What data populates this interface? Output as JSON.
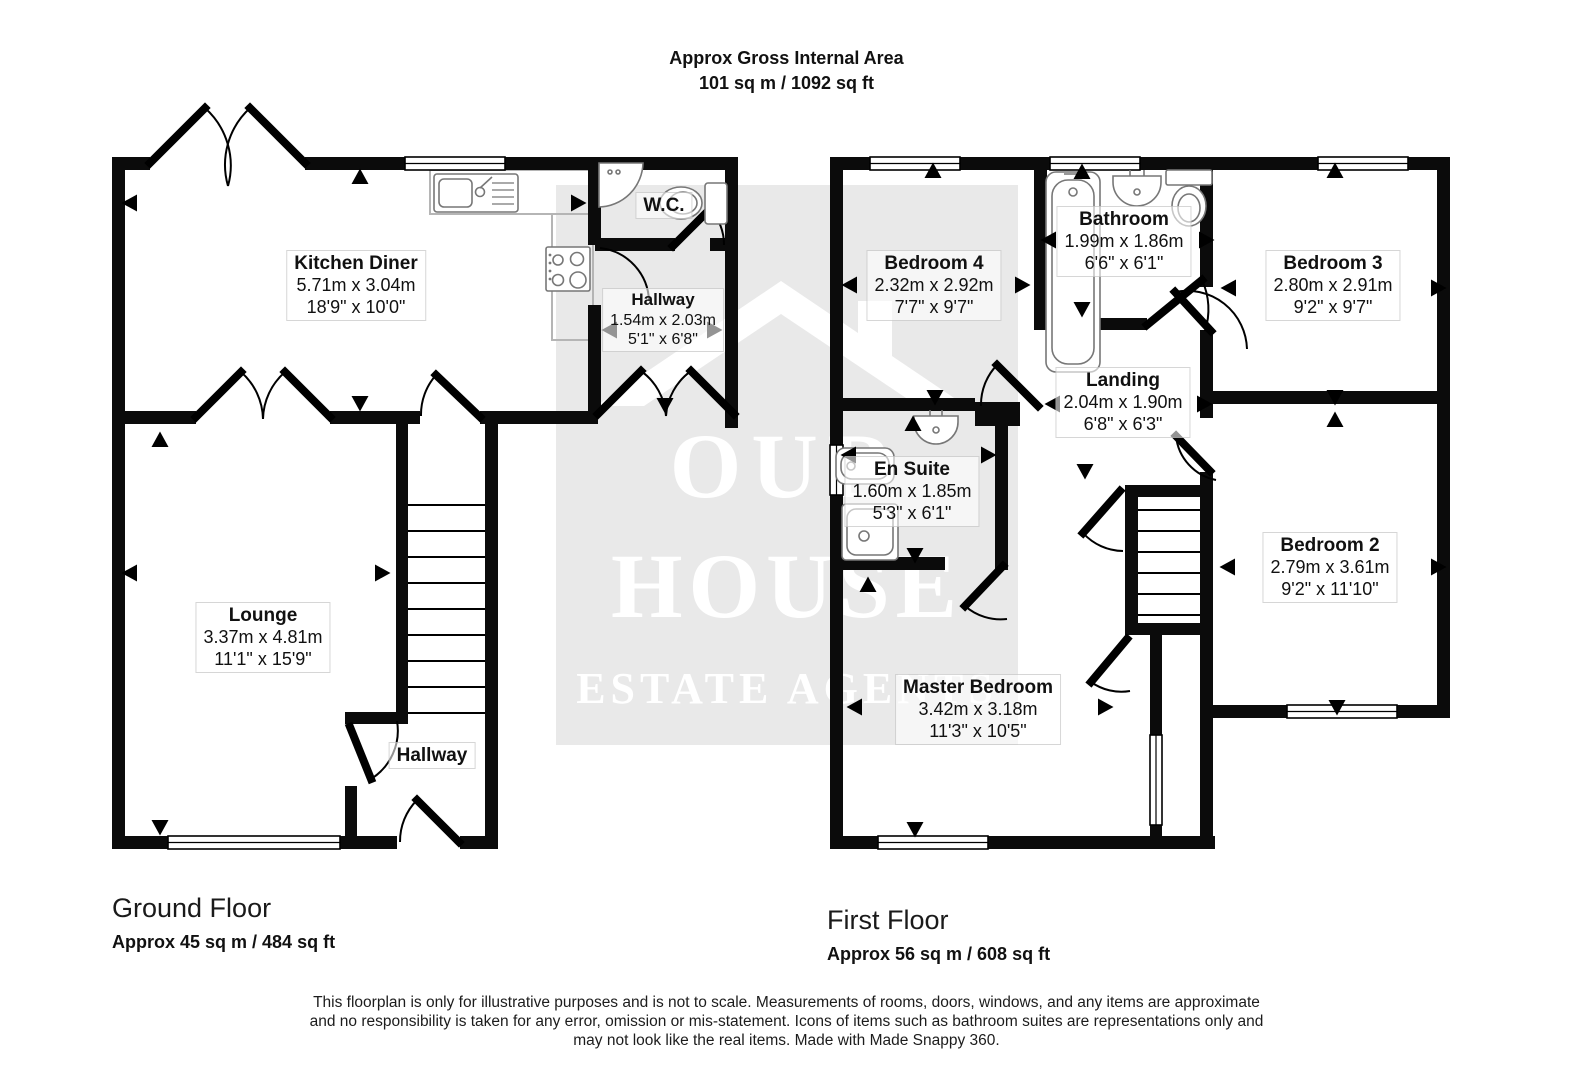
{
  "title": {
    "line1": "Approx Gross Internal Area",
    "line2": "101 sq m / 1092 sq ft"
  },
  "watermark": {
    "line1": "OUR",
    "line2": "HOUSE",
    "line3": "ESTATE AGENTS"
  },
  "colors": {
    "wall": "#0b0b0b",
    "watermark_box": "#e9e9e9",
    "watermark_text": "#ffffff",
    "fixture_stroke": "#777777",
    "counter_stroke": "#b5b5b5"
  },
  "floors": [
    {
      "label": "Ground Floor",
      "area": "Approx 45 sq m / 484 sq ft",
      "rooms": [
        {
          "name": "Kitchen Diner",
          "metric": "5.71m x 3.04m",
          "imperial": "18'9\" x 10'0\""
        },
        {
          "name": "W.C."
        },
        {
          "name": "Hallway",
          "metric": "1.54m x 2.03m",
          "imperial": "5'1\" x 6'8\""
        },
        {
          "name": "Lounge",
          "metric": "3.37m x 4.81m",
          "imperial": "11'1\" x 15'9\""
        },
        {
          "name": "Hallway"
        }
      ]
    },
    {
      "label": "First Floor",
      "area": "Approx 56 sq m / 608 sq ft",
      "rooms": [
        {
          "name": "Bedroom 4",
          "metric": "2.32m x 2.92m",
          "imperial": "7'7\" x 9'7\""
        },
        {
          "name": "Bathroom",
          "metric": "1.99m x 1.86m",
          "imperial": "6'6\" x 6'1\""
        },
        {
          "name": "Bedroom 3",
          "metric": "2.80m x 2.91m",
          "imperial": "9'2\" x 9'7\""
        },
        {
          "name": "Landing",
          "metric": "2.04m x 1.90m",
          "imperial": "6'8\" x 6'3\""
        },
        {
          "name": "En Suite",
          "metric": "1.60m x 1.85m",
          "imperial": "5'3\" x 6'1\""
        },
        {
          "name": "Bedroom 2",
          "metric": "2.79m x 3.61m",
          "imperial": "9'2\" x 11'10\""
        },
        {
          "name": "Master Bedroom",
          "metric": "3.42m x 3.18m",
          "imperial": "11'3\" x 10'5\""
        }
      ]
    }
  ],
  "footer": {
    "line1": "This floorplan is only for illustrative purposes and is not to scale. Measurements of rooms, doors, windows, and any items are approximate",
    "line2": "and no responsibility is taken for any error, omission or mis-statement. Icons of items such as bathroom suites are representations only and",
    "line3": "may not look like the real items. Made with Made Snappy 360."
  }
}
